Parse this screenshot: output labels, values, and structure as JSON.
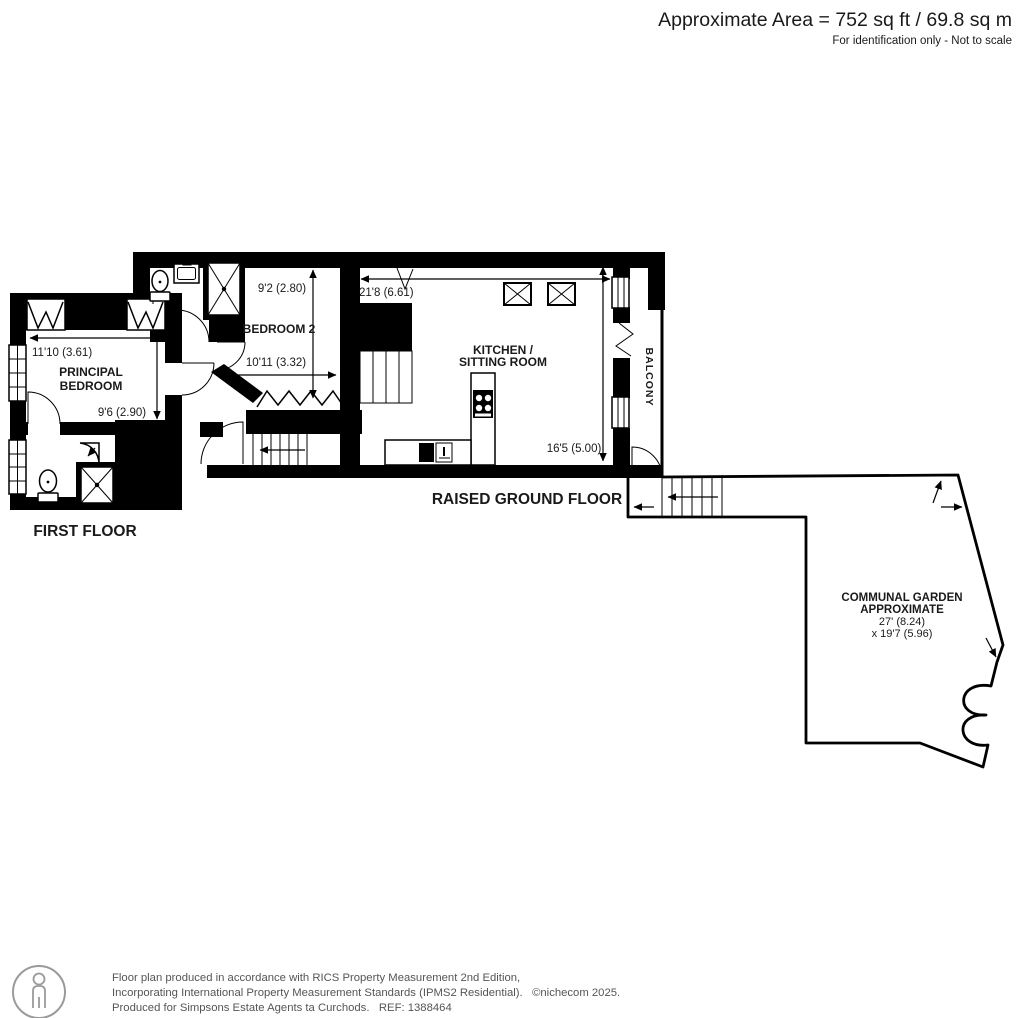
{
  "header": {
    "area": "Approximate Area = 752 sq ft / 69.8 sq m",
    "disclaimer": "For identification only - Not to scale"
  },
  "first_floor": {
    "label": "FIRST FLOOR",
    "principal_bedroom": {
      "name_line1": "PRINCIPAL",
      "name_line2": "BEDROOM",
      "dim_width": "11'10 (3.61)",
      "dim_depth": "9'6 (2.90)"
    },
    "bedroom2": {
      "name": "BEDROOM 2",
      "dim_width": "10'11 (3.32)",
      "dim_depth": "9'2 (2.80)"
    }
  },
  "raised_ground_floor": {
    "label": "RAISED GROUND FLOOR",
    "kitchen": {
      "name_line1": "KITCHEN /",
      "name_line2": "SITTING ROOM",
      "dim_width": "21'8 (6.61)",
      "dim_depth": "16'5 (5.00)"
    },
    "balcony": {
      "name": "BALCONY"
    }
  },
  "garden": {
    "name_line1": "COMMUNAL GARDEN",
    "name_line2": "APPROXIMATE",
    "dim1": "27' (8.24)",
    "dim2": "x 19'7 (5.96)"
  },
  "footer": {
    "line1": "Floor plan produced in accordance with RICS Property Measurement 2nd Edition,",
    "line2": "Incorporating International Property Measurement Standards (IPMS2 Residential).   ©nichecom 2025.",
    "line3": "Produced for Simpsons Estate Agents ta Curchods.   REF: 1388464"
  },
  "colors": {
    "wall": "#000000",
    "text": "#1a1a1a",
    "footer_text": "#555555",
    "footer_icon": "#9a9a9a",
    "background": "#ffffff"
  }
}
